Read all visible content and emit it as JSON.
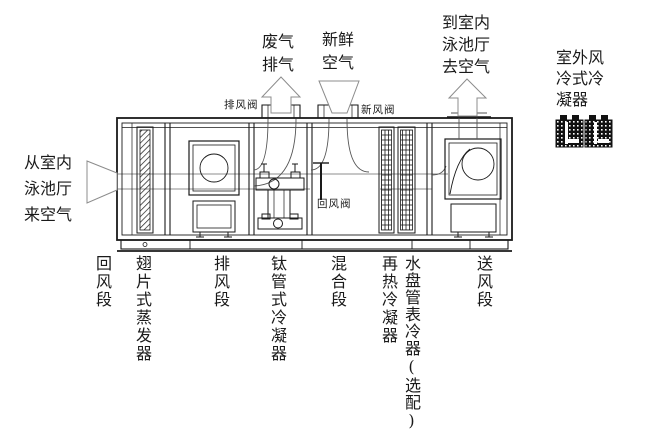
{
  "diagram": {
    "flow_labels": {
      "from_pool": "从室内\n泳池厅\n来空气",
      "waste_exhaust": "废气\n排气",
      "fresh_air": "新鲜\n空气",
      "to_pool": "到室内\n泳池厅\n去空气",
      "outdoor_condenser": "室外风\n冷式冷\n凝器"
    },
    "damper_labels": {
      "exhaust_damper": "排风阀",
      "fresh_air_damper": "新风阀",
      "return_air_damper": "回风阀"
    },
    "section_labels": [
      {
        "id": "return-air-section",
        "text": "回风段"
      },
      {
        "id": "finned-evaporator",
        "text": "翅片式蒸发器"
      },
      {
        "id": "exhaust-fan-section",
        "text": "排风段"
      },
      {
        "id": "titanium-tube-condenser",
        "text": "钛管式冷凝器"
      },
      {
        "id": "mixing-section",
        "text": "混合段"
      },
      {
        "id": "reheat-condenser",
        "text": "再热冷凝器"
      },
      {
        "id": "water-coil-optional",
        "text": "水盘管表冷器(选配)"
      },
      {
        "id": "supply-fan-section",
        "text": "送风段"
      }
    ],
    "colors": {
      "line": "#1a1a1a",
      "arrow": "#8c8c8c",
      "background": "#ffffff"
    }
  }
}
